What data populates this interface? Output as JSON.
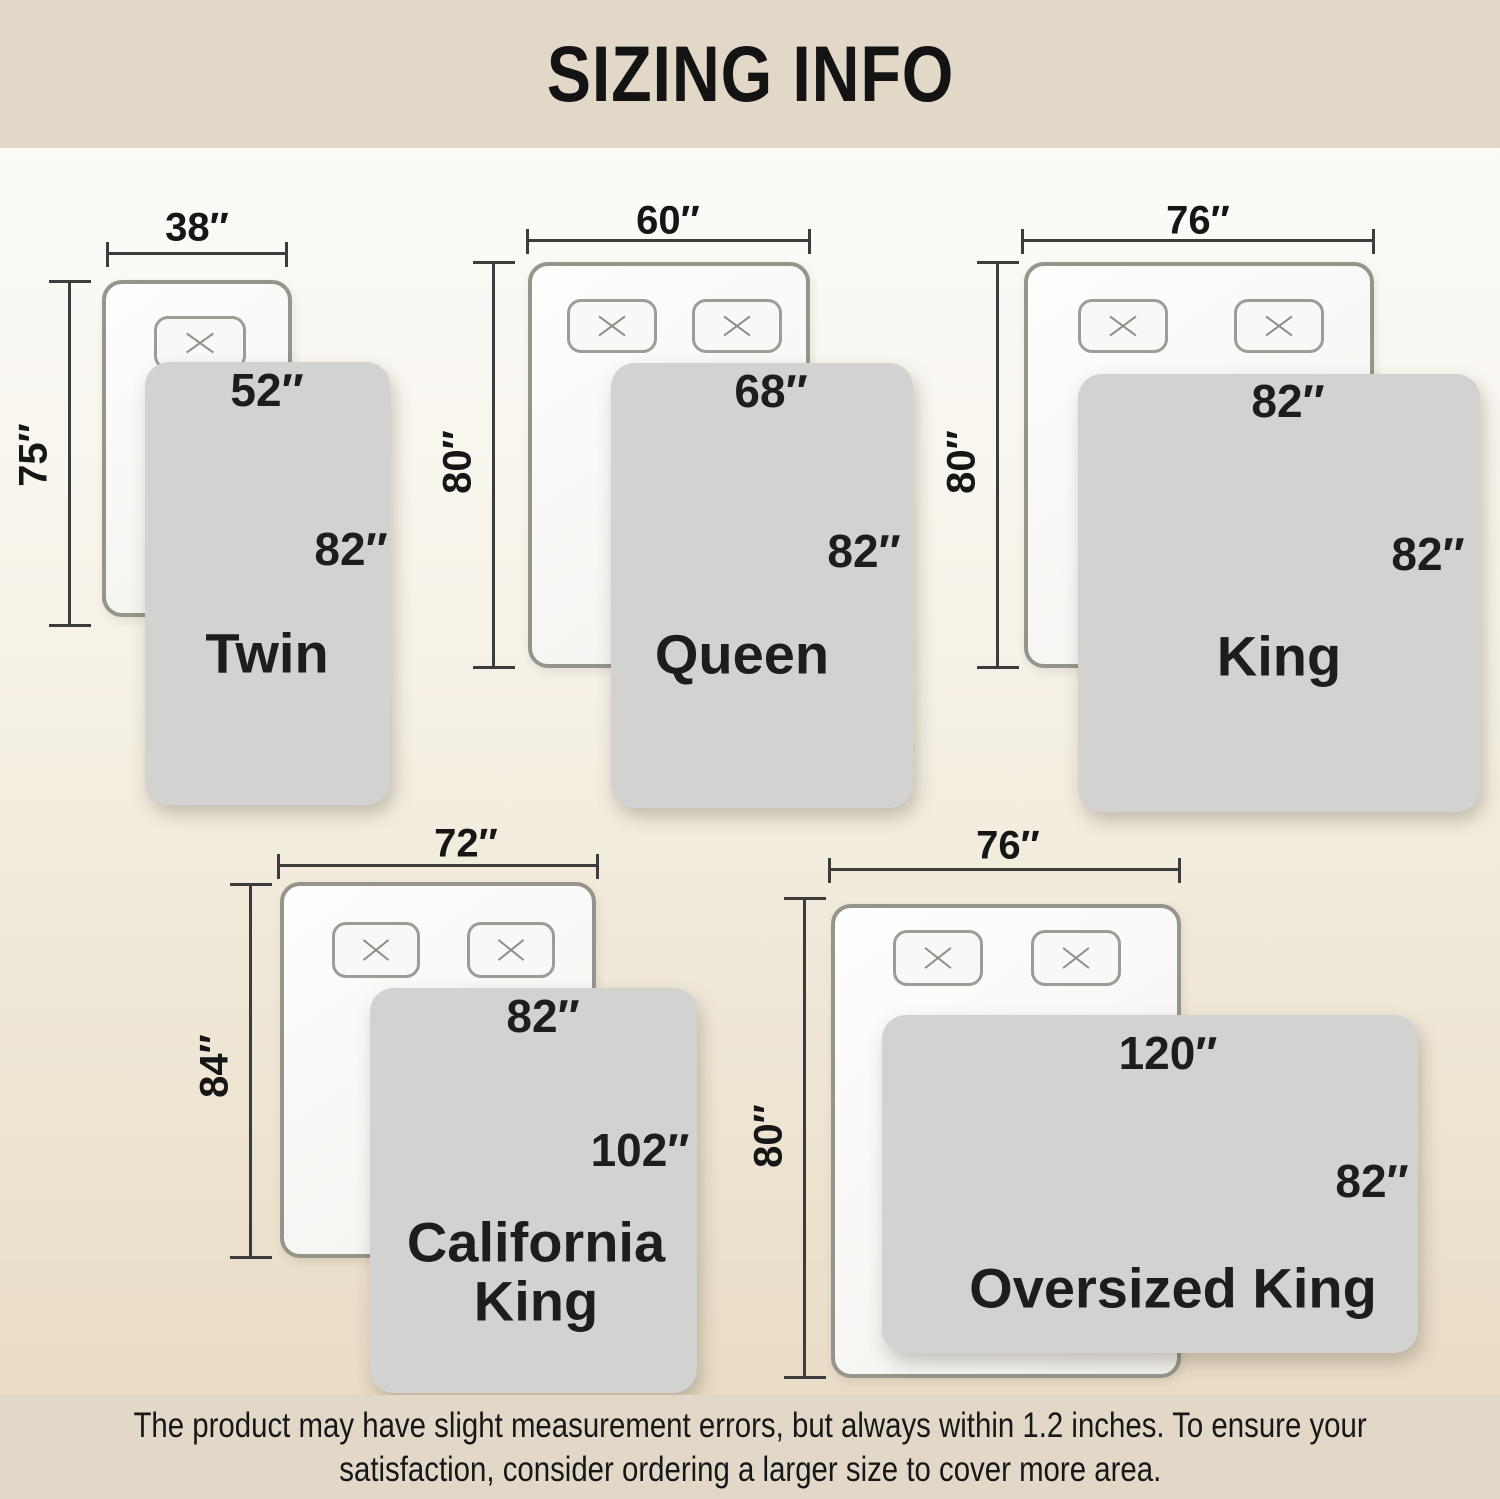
{
  "header": {
    "title": "SIZING INFO"
  },
  "sizes": [
    {
      "name": "Twin",
      "bed_width": "38″",
      "bed_height": "75″",
      "blanket_width": "52″",
      "blanket_height": "82″"
    },
    {
      "name": "Queen",
      "bed_width": "60″",
      "bed_height": "80″",
      "blanket_width": "68″",
      "blanket_height": "82″"
    },
    {
      "name": "King",
      "bed_width": "76″",
      "bed_height": "80″",
      "blanket_width": "82″",
      "blanket_height": "82″"
    },
    {
      "name": "California King",
      "bed_width": "72″",
      "bed_height": "84″",
      "blanket_width": "82″",
      "blanket_height": "102″"
    },
    {
      "name": "Oversized King",
      "bed_width": "76″",
      "bed_height": "80″",
      "blanket_width": "120″",
      "blanket_height": "82″"
    }
  ],
  "footer": {
    "line1": "The product may have slight measurement errors, but always within 1.2 inches. To ensure your",
    "line2": "satisfaction, consider ordering a larger size to cover more area."
  },
  "colors": {
    "band_background": "#e2d8c7",
    "body_gradient_top": "#fdfdfb",
    "body_gradient_bottom": "#e8dac3",
    "blanket_fill": "#d2d2d1",
    "bed_outline": "#95958e",
    "dimension_line": "#3c3c3c",
    "text": "#161616"
  },
  "icons": {
    "pillow_marker": "x-cross-icon"
  }
}
